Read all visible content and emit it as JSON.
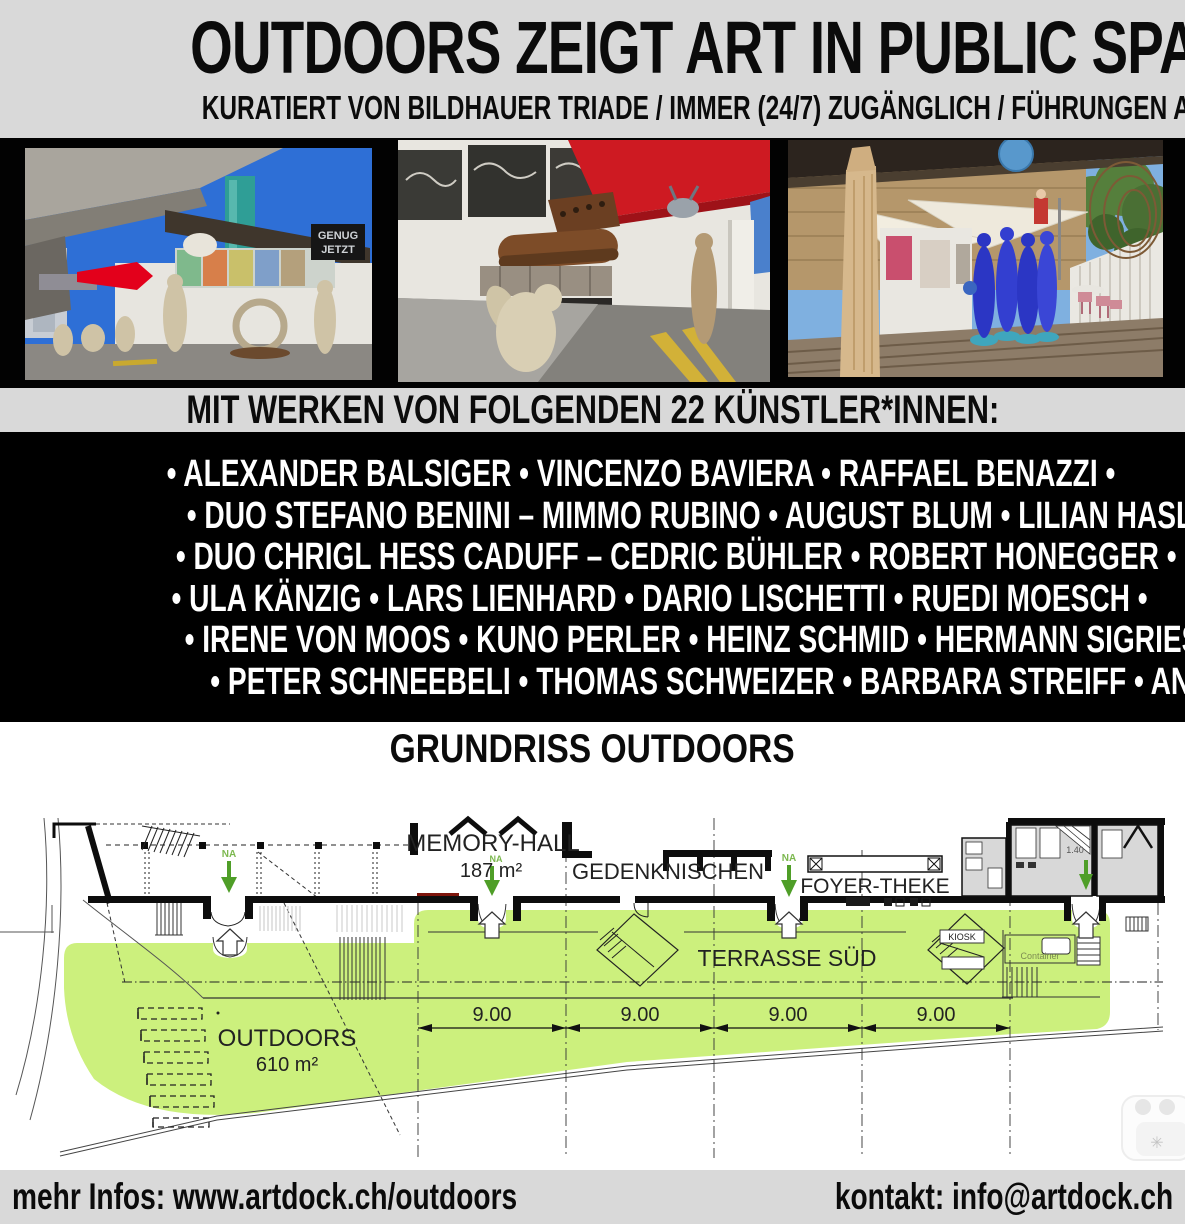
{
  "header": {
    "title": "OUTDOORS ZEIGT ART IN PUBLIC SPACE",
    "subtitle": "KURATIERT VON BILDHAUER TRIADE / IMMER (24/7) ZUGÄNGLICH / FÜHRUNGEN AUF ANFRAGE"
  },
  "photos": {
    "photo1": {
      "sign_line1": "GENUG",
      "sign_line2": "JETZT"
    }
  },
  "banner": {
    "text": "MIT WERKEN VON FOLGENDEN 22 KÜNSTLER*INNEN:"
  },
  "artists": {
    "lines": [
      "• ALEXANDER BALSIGER • VINCENZO BAVIERA • RAFFAEL BENAZZI •",
      "• DUO STEFANO BENINI – MIMMO RUBINO • AUGUST BLUM • LILIAN HASLER •",
      "• DUO CHRIGL HESS CADUFF – CEDRIC BÜHLER • ROBERT HONEGGER •",
      "• ULA KÄNZIG • LARS LIENHARD • DARIO LISCHETTI • RUEDI MOESCH •",
      "• IRENE VON MOOS • KUNO PERLER • HEINZ SCHMID • HERMANN SIGRIEST •",
      "• PETER SCHNEEBELI • THOMAS SCHWEIZER • BARBARA STREIFF • ANDRE WILHELM •"
    ]
  },
  "plan": {
    "heading": "GRUNDRISS OUTDOORS",
    "labels": {
      "memory_hall": "MEMORY-HALL",
      "memory_hall_area": "187 m²",
      "gedenknischen": "GEDENKNISCHEN",
      "foyer_theke": "FOYER-THEKE",
      "terrasse_sued": "TERRASSE SÜD",
      "outdoors": "OUTDOORS",
      "outdoors_area": "610 m²",
      "kiosk": "KIOSK",
      "container": "Container",
      "na": "NA",
      "dim_140": "1.40"
    },
    "dims": [
      "9.00",
      "9.00",
      "9.00",
      "9.00"
    ]
  },
  "footer": {
    "left": "mehr Infos: www.artdock.ch/outdoors",
    "right": "kontakt: info@artdock.ch"
  },
  "colors": {
    "band_gray": "#d9d9d9",
    "block_black": "#000000",
    "highlight_green": "#ccf07d",
    "arrow_green": "#4f9e28"
  }
}
